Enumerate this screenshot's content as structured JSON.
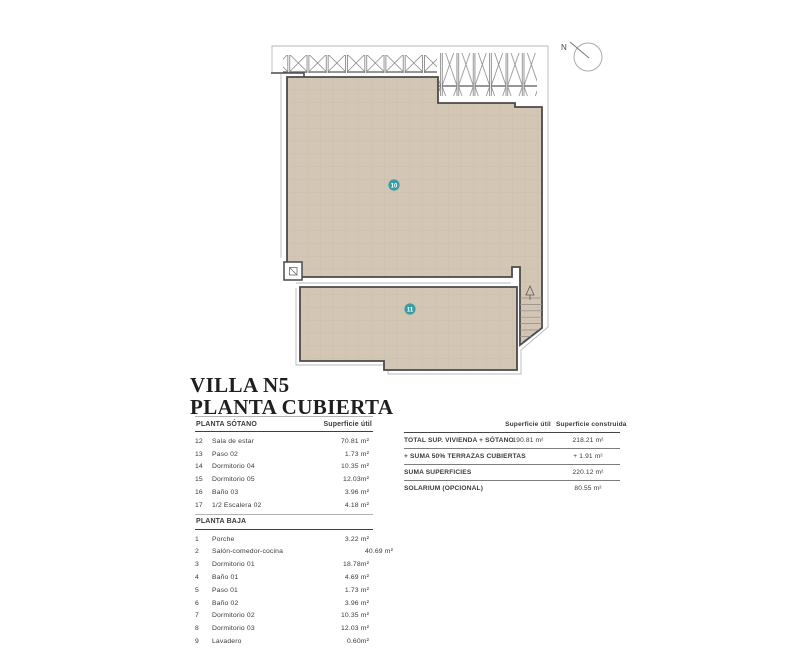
{
  "page": {
    "title_line1": "VILLA N5",
    "title_line2": "PLANTA CUBIERTA"
  },
  "plan": {
    "north_label": "N",
    "markers": [
      {
        "id": "10"
      },
      {
        "id": "11"
      }
    ],
    "colors": {
      "roof_fill": "#d3c6b4",
      "roof_grid": "#c7baa8",
      "wall": "#4a4a4a",
      "thin_line": "#b9b9b9",
      "marker_fill": "#3a9da4",
      "text": "#3a3a3a"
    }
  },
  "tables": {
    "sotano": {
      "title": "PLANTA SÓTANO",
      "col_header": "Superficie útil",
      "rows": [
        {
          "num": "12",
          "name": "Sala de estar",
          "value": "70.81 m²"
        },
        {
          "num": "13",
          "name": "Paso 02",
          "value": "1.73 m²"
        },
        {
          "num": "14",
          "name": "Dormitorio 04",
          "value": "10.35 m²"
        },
        {
          "num": "15",
          "name": "Dormitorio 05",
          "value": "12.03m²"
        },
        {
          "num": "16",
          "name": "Baño 03",
          "value": "3.96 m²"
        },
        {
          "num": "17",
          "name": "1/2 Escalera 02",
          "value": "4.18 m²"
        }
      ]
    },
    "baja": {
      "title": "PLANTA BAJA",
      "rows": [
        {
          "num": "1",
          "name": "Porche",
          "value": "3.22 m²"
        },
        {
          "num": "2",
          "name": "Salón-comedor-cocina",
          "value": "40.69 m²"
        },
        {
          "num": "3",
          "name": "Dormitorio 01",
          "value": "18.78m²"
        },
        {
          "num": "4",
          "name": "Baño 01",
          "value": "4.69 m²"
        },
        {
          "num": "5",
          "name": "Paso 01",
          "value": "1.73 m²"
        },
        {
          "num": "6",
          "name": "Baño 02",
          "value": "3.96 m²"
        },
        {
          "num": "7",
          "name": "Dormitorio 02",
          "value": "10.35 m²"
        },
        {
          "num": "8",
          "name": "Dormitorio 03",
          "value": "12.03 m²"
        },
        {
          "num": "9",
          "name": "Lavadero",
          "value": "0.60m²"
        }
      ]
    },
    "summary": {
      "col1_header": "Superficie útil",
      "col2_header": "Superficie construida",
      "rows": [
        {
          "label": "TOTAL SUP. VIVIENDA + SÓTANO",
          "util": "190.81 m²",
          "constr": "218.21 m²"
        },
        {
          "label": "+ SUMA 50% TERRAZAS CUBIERTAS",
          "util": "",
          "constr": "+ 1.91 m²"
        },
        {
          "label": "SUMA SUPERFICIES",
          "util": "",
          "constr": "220.12 m²"
        },
        {
          "label": "SOLARIUM (OPCIONAL)",
          "util": "",
          "constr": "80.55 m²"
        }
      ]
    }
  }
}
